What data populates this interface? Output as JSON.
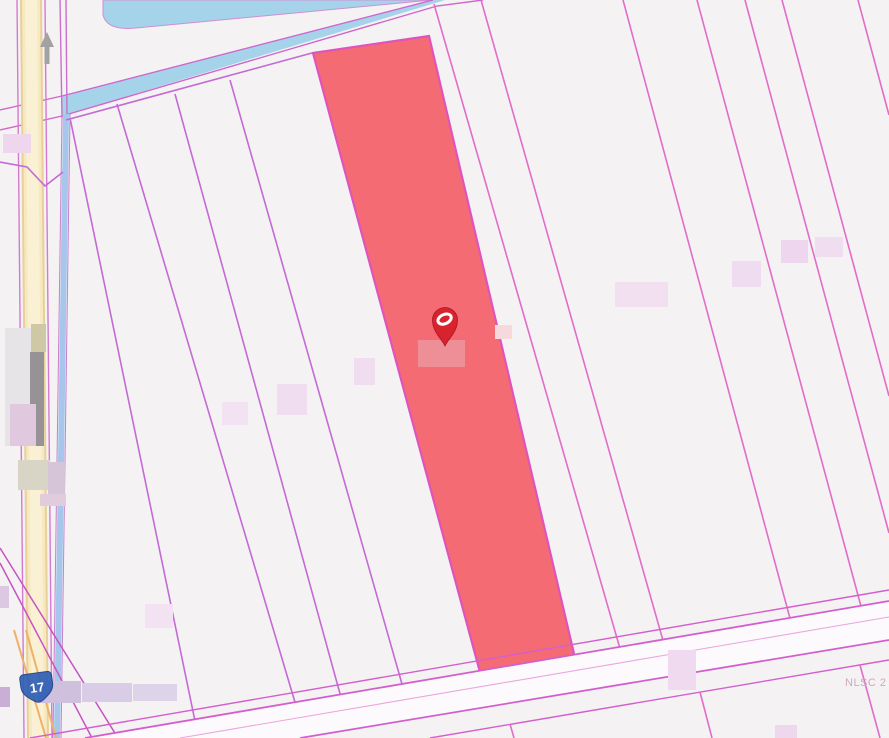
{
  "map": {
    "watermark_text": "NLSC 2",
    "route_shield": {
      "label": "17"
    },
    "icons": {
      "pin": "map-pin-icon",
      "direction_arrow": "up-arrow-icon",
      "shield": "highway-shield-icon"
    },
    "colors": {
      "background": "#f5f2f4",
      "parcel_line": "#c46ad4",
      "parcel_line_right": "#e26cc8",
      "road_line": "#d35fce",
      "highlight_fill": "#f56b73",
      "highlight_border": "#de54bc",
      "water": "#a5d3e9",
      "road_yellow": "#f6e9c0",
      "road_yellow_center": "#faf1d4",
      "road_yellow_edge": "#e8d09a",
      "road_blue": "#a7c6ec",
      "road_orange": "#eeb168",
      "pin_red": "#d8232e",
      "shield_blue": "#2f5fb5",
      "watermark": "#d2a8bc",
      "blur_label_pink": "#f0dcf0",
      "blur_label_lavender": "#d2c4e2",
      "blur_label_gray": "#969296"
    }
  }
}
